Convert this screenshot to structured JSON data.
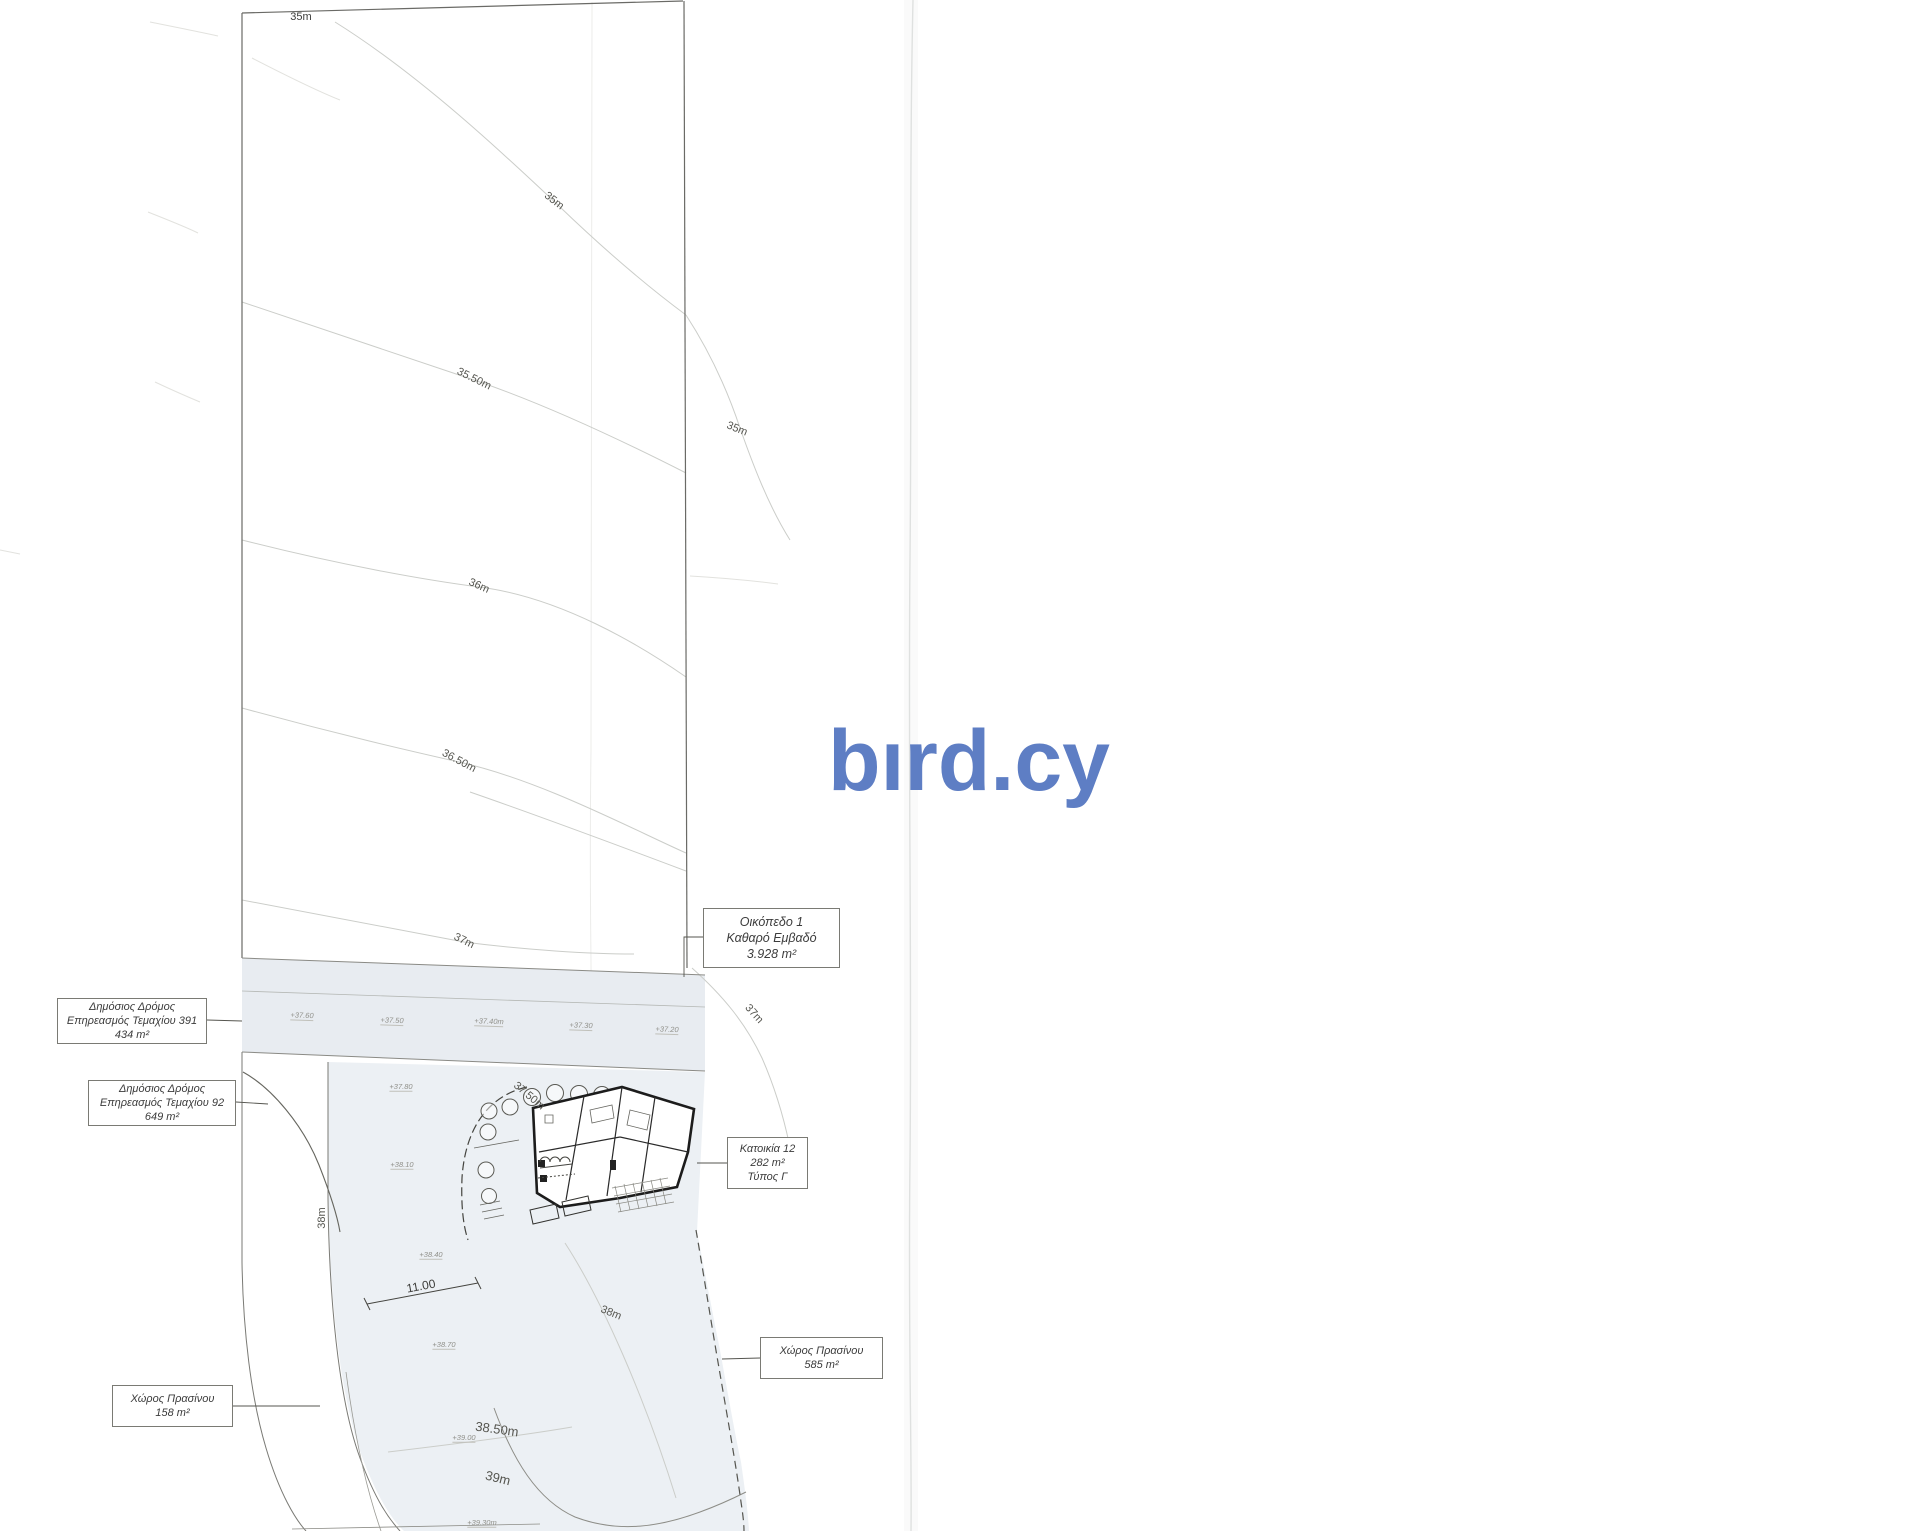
{
  "watermark": {
    "text": "bırd.cy",
    "color": "#5e7ec4"
  },
  "boundary": {
    "top_width": "35m"
  },
  "contours": {
    "c35_top": "35m",
    "c35_mid": "35m",
    "c35_right": "35m",
    "c3550": "35.50m",
    "c36": "36m",
    "c3650": "36.50m",
    "c37_left": "37m",
    "c37_right": "37m",
    "c3750": "37.50m",
    "c38_left": "38m",
    "c38_right": "38m",
    "c3850": "38.50m",
    "c39": "39m"
  },
  "spots": {
    "s1": "+37.60",
    "s2": "+37.50",
    "s3": "+37.40m",
    "s4": "+37.30",
    "s5": "+37.20",
    "s6": "+37.80",
    "s7": "+38.10",
    "s8": "+38.40",
    "s9": "+38.70",
    "s10": "+39.00",
    "s11": "+39.30m"
  },
  "dimension": "11.00",
  "boxes": {
    "road391": {
      "lines": [
        "Δημόσιος Δρόμος",
        "Επηρεασμός Τεμαχίου 391",
        "434 m²"
      ]
    },
    "road92": {
      "lines": [
        "Δημόσιος Δρόμος",
        "Επηρεασμός Τεμαχίου 92",
        "649 m²"
      ]
    },
    "plot1": {
      "lines": [
        "Οικόπεδο 1",
        "Καθαρό Εμβαδό",
        "3.928 m²"
      ]
    },
    "house12": {
      "lines": [
        "Κατοικία 12",
        "282 m²",
        "Τύπος Γ"
      ]
    },
    "green585": {
      "lines": [
        "Χώρος Πρασίνου",
        "585 m²"
      ]
    },
    "green158": {
      "lines": [
        "Χώρος Πρασίνου",
        "158 m²"
      ]
    }
  }
}
